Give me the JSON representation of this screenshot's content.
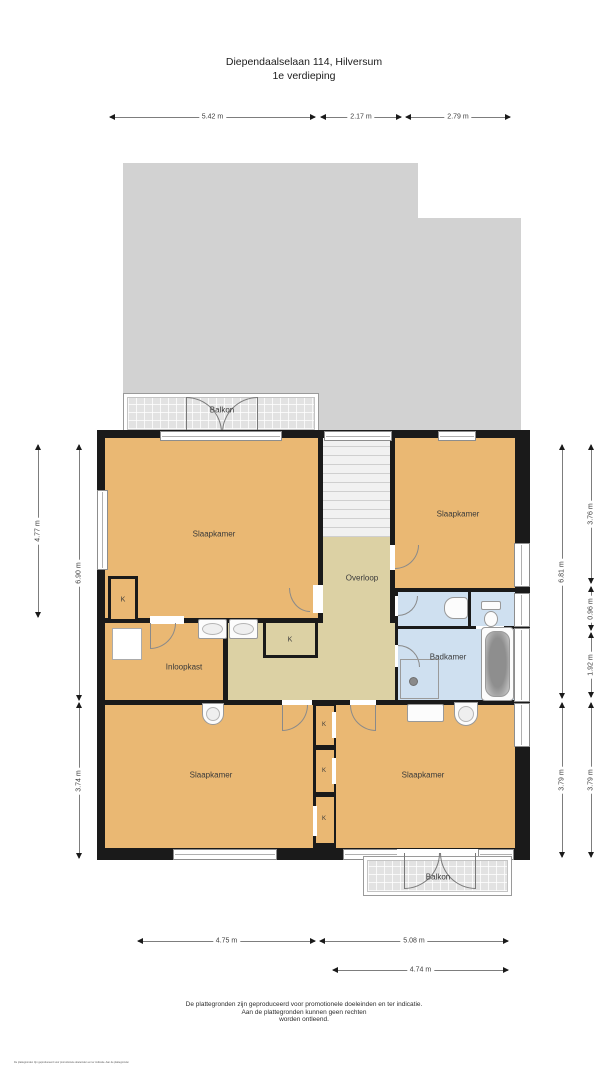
{
  "title": {
    "address": "Diependaalselaan 114, Hilversum",
    "floor": "1e verdieping"
  },
  "rooms": {
    "slaapkamer": "Slaapkamer",
    "overloop": "Overloop",
    "badkamer": "Badkamer",
    "inloopkast": "Inloopkast",
    "balkon": "Balkon",
    "kast": "K"
  },
  "dimensions": {
    "top": [
      "5.42 m",
      "2.17 m",
      "2.79 m"
    ],
    "left": [
      "4.77 m",
      "6.90 m",
      "3.74 m"
    ],
    "right_inner": [
      "6.81 m",
      "3.79 m"
    ],
    "right_outer": [
      "3.76 m",
      "0.96 m",
      "1.92 m",
      "3.79 m"
    ],
    "bottom": [
      "4.75 m",
      "5.08 m",
      "4.74 m"
    ]
  },
  "footer": {
    "line1": "De plattegronden zijn geproduceerd voor promotionele doeleinden en ter indicatie.",
    "line2": "Aan de plattegronden kunnen geen rechten",
    "line3": "worden ontleend."
  },
  "microprint": "De plattegronden zijn geproduceerd voor promotionele doeleinden en ter indicatie. Aan de plattegronden kunnen geen rechten worden ontleend.",
  "colors": {
    "room": "#eab873",
    "hall": "#dcd1a4",
    "bath": "#cfe0f0",
    "wall": "#1a1a1a",
    "roof": "#d2d2d2",
    "balkon": "#e2e2e2"
  }
}
